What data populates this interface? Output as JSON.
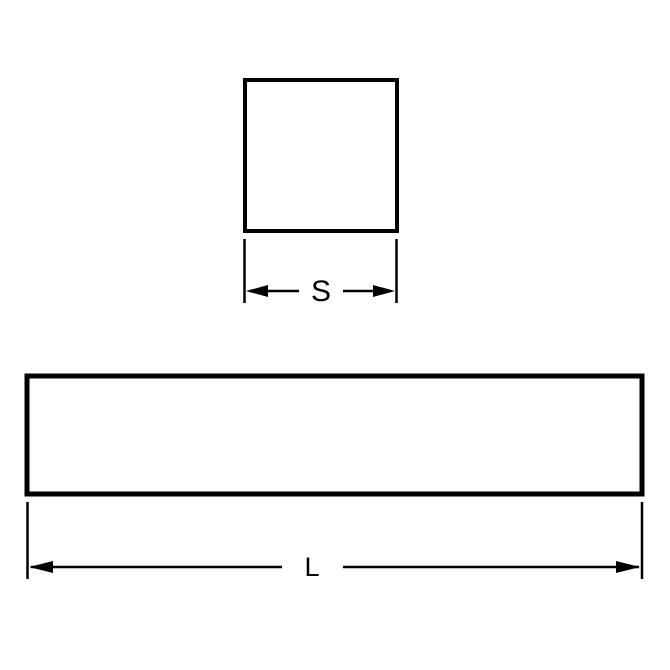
{
  "page": {
    "background_color": "#ffffff"
  },
  "drawing": {
    "line_color": "#000000",
    "cross_section_view": {
      "shape": "square",
      "dimension_label": "S"
    },
    "length_view": {
      "shape": "rectangle",
      "dimension_label": "L"
    }
  }
}
